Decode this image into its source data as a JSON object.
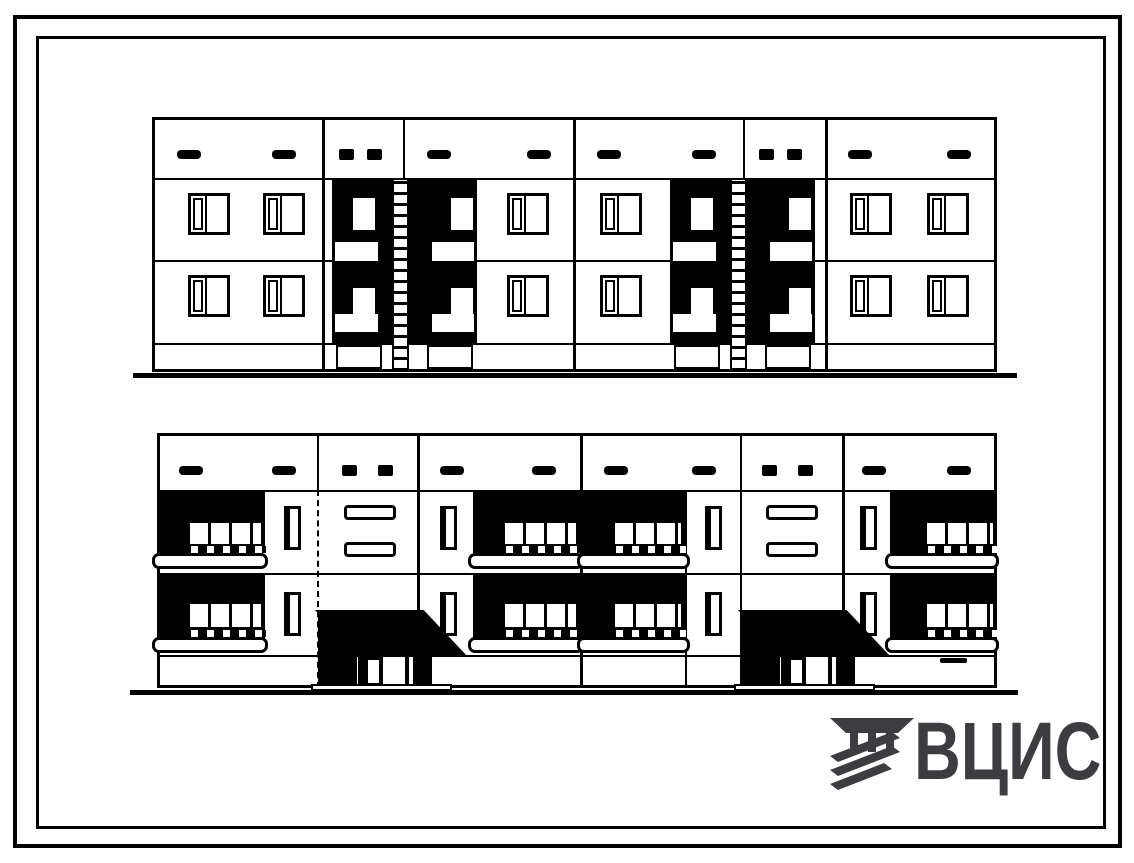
{
  "colors": {
    "ink": "#000000",
    "paper": "#ffffff",
    "logo": "#3c3c41"
  },
  "logo": {
    "text": "ВЦИС"
  },
  "drawing": {
    "frame": {
      "outer": {
        "x": 13,
        "y": 15,
        "w": 1109,
        "h": 833,
        "bw": 4
      },
      "inner": {
        "x": 36,
        "y": 36,
        "w": 1070,
        "h": 793,
        "bw": 3
      }
    },
    "top_elevation": {
      "label": "rear-facade-elevation",
      "body": {
        "x": 152,
        "y": 117,
        "w": 845,
        "h": 255
      },
      "hlines": [
        178,
        260,
        343
      ],
      "vlines": [
        {
          "x": 322,
          "w": 3
        },
        {
          "x": 403,
          "w": 2
        },
        {
          "x": 573,
          "w": 3
        },
        {
          "x": 743,
          "w": 2
        },
        {
          "x": 825,
          "w": 3
        }
      ],
      "window": {
        "w": 42,
        "h": 42,
        "rows": [
          193,
          275
        ],
        "cols": [
          188,
          263,
          507,
          600,
          850,
          927
        ]
      },
      "vents": {
        "dash": {
          "y": 150,
          "w": 24,
          "h": 9,
          "xs": [
            177,
            272,
            427,
            527,
            597,
            692,
            848,
            947
          ]
        },
        "square": {
          "y": 149,
          "w": 15,
          "h": 11,
          "xs": [
            339,
            367,
            759,
            787
          ]
        }
      },
      "stair_blocks": {
        "xs": [
          332,
          670
        ],
        "y": 178,
        "w": 145,
        "h": 165,
        "squares": [
          {
            "dx": 21,
            "dy": 20,
            "w": 22,
            "h": 32
          },
          {
            "dx": 119,
            "dy": 20,
            "w": 22,
            "h": 32
          },
          {
            "dx": 21,
            "dy": 110,
            "w": 22,
            "h": 28
          },
          {
            "dx": 119,
            "dy": 110,
            "w": 22,
            "h": 28
          }
        ],
        "strips": [
          {
            "dx": 3,
            "dy": 64,
            "w": 43,
            "h": 19
          },
          {
            "dx": 100,
            "dy": 64,
            "w": 42,
            "h": 19
          },
          {
            "dx": 3,
            "dy": 136,
            "w": 43,
            "h": 18
          },
          {
            "dx": 100,
            "dy": 136,
            "w": 42,
            "h": 18
          }
        ],
        "ladder": {
          "dx": 60,
          "w": 17,
          "y1": 180,
          "y2": 371
        },
        "base_panels": [
          {
            "dx": 4,
            "w": 46
          },
          {
            "dx": 95,
            "w": 46
          }
        ],
        "base_panel_y": 345,
        "base_panel_h": 24
      },
      "ground": {
        "x": 133,
        "y": 373,
        "w": 884,
        "h": 5
      }
    },
    "bottom_elevation": {
      "label": "street-facade-elevation",
      "body": {
        "x": 157,
        "y": 433,
        "w": 840,
        "h": 255
      },
      "hlines": [
        490,
        573,
        655
      ],
      "vlines": [
        {
          "x": 317,
          "w": 2,
          "dashed": true
        },
        {
          "x": 417,
          "w": 3
        },
        {
          "x": 580,
          "w": 3
        },
        {
          "x": 685,
          "w": 2,
          "y1": 490
        },
        {
          "x": 740,
          "w": 2
        },
        {
          "x": 842,
          "w": 3
        }
      ],
      "vents": {
        "dash": {
          "y": 466,
          "w": 24,
          "h": 9,
          "xs": [
            179,
            272,
            440,
            532,
            604,
            692,
            862,
            947
          ]
        },
        "square": {
          "y": 465,
          "w": 15,
          "h": 11,
          "xs": [
            342,
            378,
            762,
            798
          ]
        }
      },
      "balconies": {
        "units": [
          {
            "x": 157,
            "bw": 108,
            "gx": 185,
            "gw": 78,
            "sx": 152,
            "sw": 116
          },
          {
            "x": 473,
            "bw": 107,
            "gx": 500,
            "gw": 78,
            "sx": 468,
            "sw": 116
          },
          {
            "x": 582,
            "bw": 103,
            "gx": 610,
            "gw": 73,
            "sx": 577,
            "sw": 113
          },
          {
            "x": 890,
            "bw": 107,
            "gx": 922,
            "gw": 73,
            "sx": 885,
            "sw": 114
          }
        ],
        "rows": [
          {
            "by": 490,
            "bh": 63,
            "gy": 521,
            "gh": 25,
            "dy": 546,
            "dh": 7,
            "sy": 553,
            "sh": 16
          },
          {
            "by": 573,
            "bh": 65,
            "gy": 602,
            "gh": 27,
            "dy": 630,
            "dh": 7,
            "sy": 637,
            "sh": 16
          }
        ]
      },
      "narrow_windows": {
        "w": 17,
        "h": 44,
        "rows": [
          506,
          592
        ],
        "cols": [
          284,
          440,
          705,
          860
        ]
      },
      "slot_windows": {
        "w": 52,
        "h": 15,
        "rows": [
          505,
          542
        ],
        "cols": [
          344,
          766
        ]
      },
      "entrances": {
        "xs": [
          315,
          738
        ],
        "canopy": {
          "y": 610,
          "w": 153,
          "h": 47,
          "clip": "polygon(0% 0%, 71% 0%, 100% 100%, 27% 100%)"
        },
        "pillar": {
          "dx": 3,
          "w": 39,
          "y": 612,
          "h": 76
        },
        "door": {
          "dx": 43,
          "w": 74,
          "y": 651,
          "h": 37,
          "panes": [
            {
              "dx": 10,
              "dy": 9,
              "w": 11,
              "h": 23
            },
            {
              "dx": 25,
              "dy": 6,
              "w": 22,
              "h": 28
            },
            {
              "dx": 51,
              "dy": 6,
              "w": 4,
              "h": 28
            }
          ]
        },
        "step": {
          "dx": -4,
          "w": 141,
          "y": 684,
          "h": 7
        }
      },
      "basement_vent": {
        "x": 940,
        "y": 658,
        "w": 27,
        "h": 5
      },
      "ground": {
        "x": 130,
        "y": 690,
        "w": 888,
        "h": 5
      }
    }
  }
}
